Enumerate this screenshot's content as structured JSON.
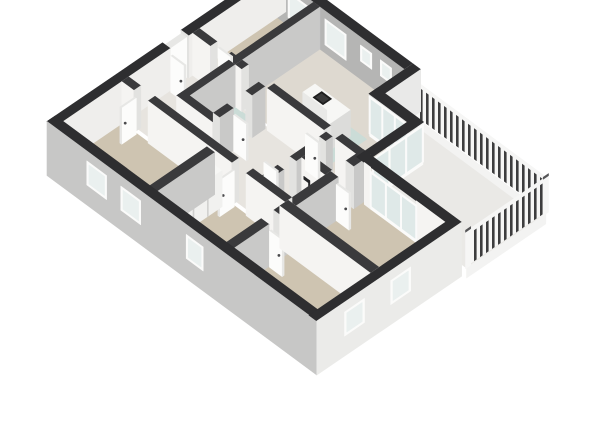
{
  "view": {
    "type": "3d-floorplan-isometric-render",
    "background": "#ffffff",
    "storey": "single floor with balcony terrace"
  },
  "palette": {
    "bg": "#ffffff",
    "wall_cap_ext": "#2e2e30",
    "wall_cap_int": "#3a3a3c",
    "ext_sw_facade": "#c7c7c6",
    "ext_se_facade": "#ebebe9",
    "ne_wall_inner": "#b5b5b4",
    "nw_wall_inner": "#efeeec",
    "face_south_white": "#f5f4f2",
    "face_east_gray": "#c9c9c8",
    "jamb": "#e2e2e0",
    "stub_bright": "#e9e9e8",
    "floor_living": "#ded9d0",
    "floor_carpet_beige": "#cec4b1",
    "floor_hall": "#e7e4df",
    "floor_tile_teal": "#cbdcd7",
    "floor_balcony": "#eae9e6",
    "glass_panel": "#dfe9e8",
    "window_frame": "#fbfbfa",
    "window_glass": "#eaf0ef",
    "island_top": "#f7f7f5",
    "island_side": "#e9e9e7",
    "island_front": "#dcdcda",
    "cooktop": "#1e1e1e",
    "cooktop_inner": "#3a3a3a",
    "rail_white": "#f6f6f5",
    "rail_slat": "#3d3d3e",
    "rail_post_cap": "#555557",
    "slab_edge": "#f3f3f2",
    "door": "#fcfcfb",
    "door_edge": "#e7e7e5",
    "handle": "#4a4a4c",
    "fixture_dark": "#242426",
    "wardrobe_front": "#f1f1ef",
    "wardrobe_divider": "#cfcfcd",
    "item_red": "#8f3a38",
    "item_blue": "#3a4a66",
    "item_olive": "#777a70"
  },
  "scene": {
    "rooms": [
      {
        "id": "living-kitchen",
        "floor": "light-wood"
      },
      {
        "id": "study-nw",
        "floor": "carpet-beige"
      },
      {
        "id": "hallway",
        "floor": "light"
      },
      {
        "id": "bathroom-west",
        "floor": "tile-teal"
      },
      {
        "id": "bathroom-east",
        "floor": "tile-teal"
      },
      {
        "id": "wc-east",
        "floor": "tile-teal"
      },
      {
        "id": "bedroom-east",
        "floor": "carpet-beige"
      },
      {
        "id": "bedroom-southeast",
        "floor": "carpet-beige"
      },
      {
        "id": "bedroom-south",
        "floor": "carpet-beige"
      },
      {
        "id": "bedroom-west",
        "floor": "carpet-beige"
      },
      {
        "id": "balcony-terrace",
        "floor": "light-stone"
      }
    ],
    "features": [
      "kitchen-island-with-cooktop",
      "slatted-balcony-railing",
      "glazed-sliding-doors",
      "built-in-wardrobes-with-items",
      "open-interior-doors",
      "towel-radiator-fixture"
    ],
    "window_counts": {
      "ne_wall": 4,
      "sw_facade": 3,
      "se_facade": 2
    }
  }
}
